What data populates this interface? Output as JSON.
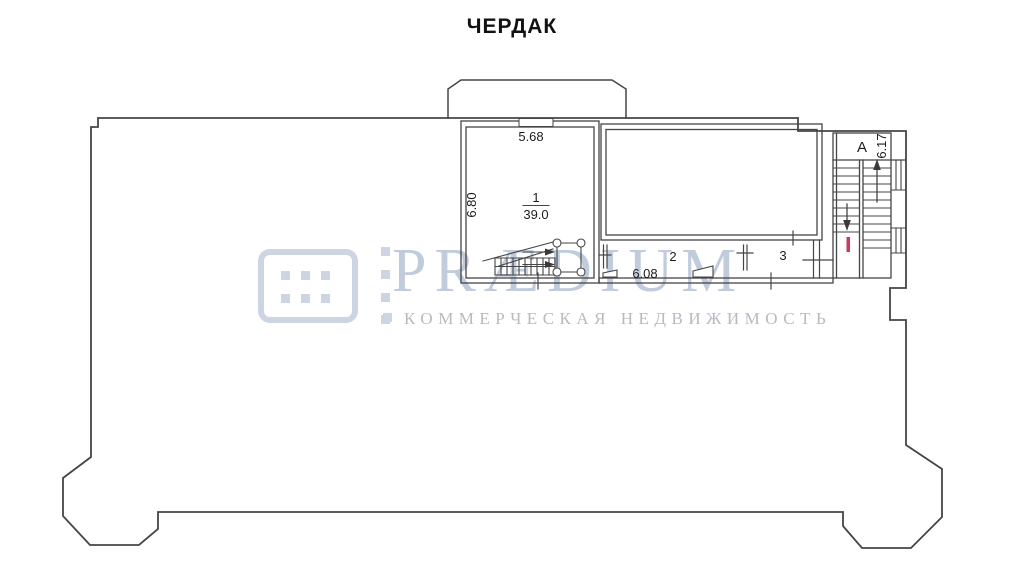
{
  "title": "ЧЕРДАК",
  "watermark": {
    "brand": "PRÆDIUM",
    "subtitle": "КОММЕРЧЕСКАЯ НЕДВИЖИМОСТЬ",
    "accent_color": "#cdd5e3",
    "brand_color": "#c0cbdc",
    "subtitle_color": "#b6bac1"
  },
  "plan": {
    "line_color": "#454545",
    "entrance_mark_color": "#cc3a55",
    "rooms": [
      {
        "id": "room-1",
        "number": "1",
        "area": "39.0",
        "width_dim": "5.68",
        "depth_dim": "6.80"
      },
      {
        "id": "room-2",
        "number": "2",
        "width_dim": "6.08"
      },
      {
        "id": "room-3",
        "number": "3"
      }
    ],
    "stairwell": {
      "letter": "A",
      "depth_dim": "6.17"
    }
  }
}
